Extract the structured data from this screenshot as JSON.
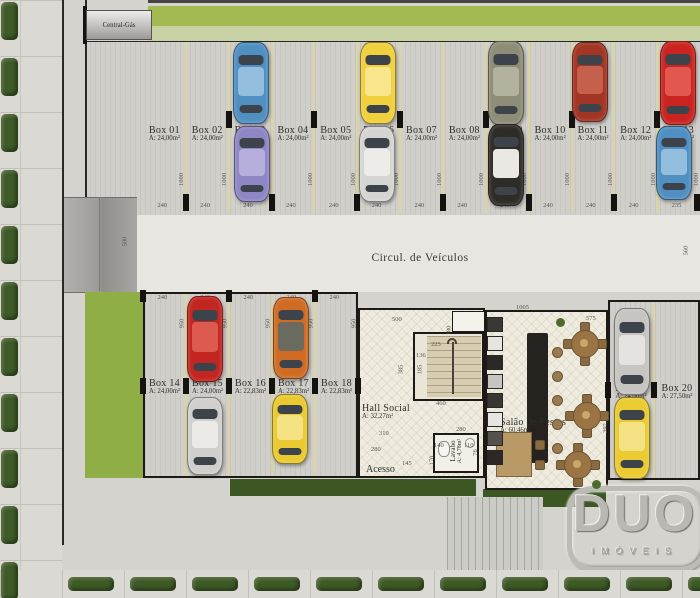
{
  "plan": {
    "central_gas": "Central-Gás",
    "circulation": "Circul. de Veículos",
    "acesso": "Acesso"
  },
  "rooms": {
    "hall": {
      "name": "Hall Social",
      "area": "A: 32,27m²"
    },
    "lavabo": {
      "name": "Lavabo",
      "area": "A: 4,78m²"
    },
    "salao": {
      "name": "Salão de Festas",
      "area": "A: 60,46m²"
    }
  },
  "parking": {
    "top_row": [
      {
        "name": "Box 01",
        "area": "A: 24,00m²",
        "width": "240",
        "depth": "1000"
      },
      {
        "name": "Box 02",
        "area": "A: 24,00m²",
        "width": "240",
        "depth": "1000"
      },
      {
        "name": "Box 03",
        "area": "A: 24,00m²",
        "width": "240",
        "depth": "1000"
      },
      {
        "name": "Box 04",
        "area": "A: 24,00m²",
        "width": "240",
        "depth": "1000"
      },
      {
        "name": "Box 05",
        "area": "A: 24,00m²",
        "width": "240",
        "depth": "1000"
      },
      {
        "name": "Box 06",
        "area": "A: 24,00m²",
        "width": "240",
        "depth": "1000"
      },
      {
        "name": "Box 07",
        "area": "A: 24,00m²",
        "width": "240",
        "depth": "1000"
      },
      {
        "name": "Box 08",
        "area": "A: 24,00m²",
        "width": "240",
        "depth": "1000"
      },
      {
        "name": "Box 09",
        "area": "A: 24,00m²",
        "width": "240",
        "depth": "1000"
      },
      {
        "name": "Box 10",
        "area": "A: 24,00m²",
        "width": "240",
        "depth": "1000"
      },
      {
        "name": "Box 11",
        "area": "A: 24,00m²",
        "width": "240",
        "depth": "1000"
      },
      {
        "name": "Box 12",
        "area": "A: 24,00m²",
        "width": "240",
        "depth": "1000"
      },
      {
        "name": "Box 13",
        "area": "A: 23,50m²",
        "width": "235",
        "depth": "1000"
      }
    ],
    "lower_left": [
      {
        "name": "Box 14",
        "area": "A: 24,00m²",
        "width": "240",
        "depth": "950"
      },
      {
        "name": "Box 15",
        "area": "A: 24,00m²",
        "width": "240",
        "depth": "950"
      },
      {
        "name": "Box 16",
        "area": "A: 22,83m²",
        "width": "240",
        "depth": "950"
      },
      {
        "name": "Box 17",
        "area": "A: 22,83m²",
        "width": "240",
        "depth": "950"
      },
      {
        "name": "Box 18",
        "area": "A: 22,83m²",
        "width": "240",
        "depth": "950"
      }
    ],
    "right": [
      {
        "name": "Box 19",
        "area": "A: 24,00m²"
      },
      {
        "name": "Box 20",
        "area": "A: 27,50m²"
      }
    ]
  },
  "dimensions": {
    "ramp_length": "500",
    "right_side": "560",
    "hall": [
      "500",
      "180",
      "225",
      "136",
      "385",
      "185",
      "460",
      "310",
      "280",
      "280",
      "140",
      "110",
      "145",
      "170",
      "76"
    ],
    "salao": [
      "1005",
      "575",
      "392,5"
    ]
  },
  "cars": [
    {
      "body": "#4f8fc2",
      "roof": "#93bedd"
    },
    {
      "body": "#f0d03c",
      "roof": "#f7e68c"
    },
    {
      "body": "#8e8d77",
      "roof": "#b3b29e"
    },
    {
      "body": "#a23523",
      "roof": "#c4604c"
    },
    {
      "body": "#cb2420",
      "roof": "#e2584e"
    },
    {
      "body": "#8f86c6",
      "roof": "#b6aedb"
    },
    {
      "body": "#d6d5d1",
      "roof": "#edece8"
    },
    {
      "body": "#2f2c27",
      "roof": "#e9e8e3"
    },
    {
      "body": "#4f8fc2",
      "roof": "#93bedd"
    },
    {
      "body": "#c32520",
      "roof": "#dd5a4f"
    },
    {
      "body": "#d06b23",
      "roof": "#6b6a5e"
    },
    {
      "body": "#d0cfcc",
      "roof": "#ebeae6"
    },
    {
      "body": "#e9ca31",
      "roof": "#f4e283"
    },
    {
      "body": "#c6c5c1",
      "roof": "#e4e3df"
    },
    {
      "body": "#eacb32",
      "roof": "#f4e284"
    }
  ],
  "logo": {
    "title": "DUO",
    "subtitle": "IMÓVEIS"
  }
}
